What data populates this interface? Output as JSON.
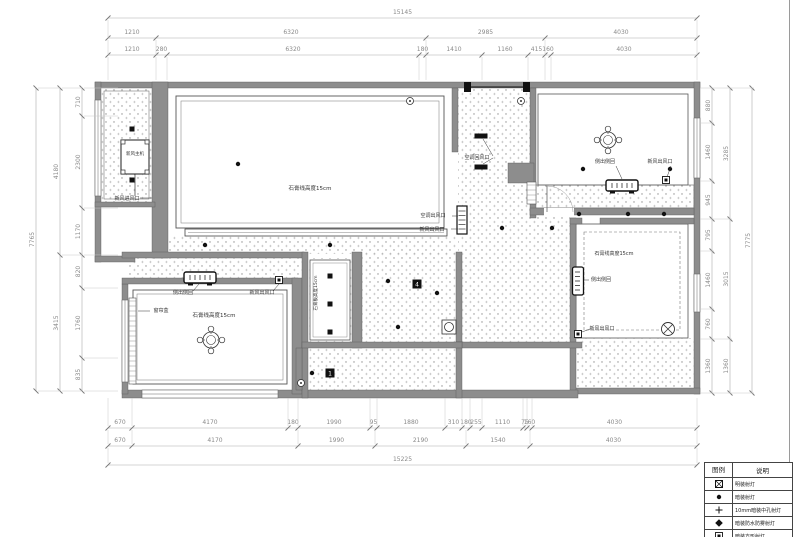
{
  "sheet": {
    "type": "ceiling-lighting-plan",
    "colors": {
      "wall": "#8d8d8d",
      "line": "#555555",
      "dim": "#8a8a8a",
      "black": "#111111",
      "paper": "#ffffff"
    }
  },
  "dimensions": {
    "top_overall": "15145",
    "top_row2": [
      "1210",
      "6320",
      "2985",
      "4030"
    ],
    "top_row3": [
      "1210",
      "280",
      "6320",
      "180",
      "1410",
      "1160",
      "415",
      "160",
      "4030"
    ],
    "bottom_row1": [
      "670",
      "4170",
      "180",
      "1990",
      "95",
      "1880",
      "310",
      "180",
      "255",
      "1110",
      "75",
      "160",
      "4030"
    ],
    "bottom_row2": [
      "670",
      "4170",
      "1990",
      "2190",
      "1540",
      "4030"
    ],
    "bottom_overall": "15225",
    "left_segments": [
      "710",
      "2300",
      "1170",
      "820",
      "1760",
      "835"
    ],
    "left_groups": [
      "4180",
      "3415"
    ],
    "left_overall": "7765",
    "right_segments": [
      "880",
      "1460",
      "945",
      "795",
      "1460",
      "760",
      "1360"
    ],
    "right_groups": [
      "3285",
      "3015",
      "1360"
    ],
    "right_overall": "7775"
  },
  "annotations": [
    {
      "text": "新风主机",
      "x": 135,
      "y": 155,
      "size": 4.5
    },
    {
      "text": "新风进风口",
      "x": 127,
      "y": 200,
      "size": 5
    },
    {
      "text": "石膏线高度15cm",
      "x": 310,
      "y": 190,
      "size": 5.5
    },
    {
      "text": "空调回风口",
      "x": 477,
      "y": 159,
      "size": 5
    },
    {
      "text": "空调出风口",
      "x": 433,
      "y": 217,
      "size": 5
    },
    {
      "text": "新风出风口",
      "x": 432,
      "y": 231,
      "size": 5
    },
    {
      "text": "侧出侧回",
      "x": 605,
      "y": 163,
      "size": 5
    },
    {
      "text": "新风出风口",
      "x": 660,
      "y": 163,
      "size": 5
    },
    {
      "text": "石膏线高度15cm",
      "x": 614,
      "y": 255,
      "size": 5
    },
    {
      "text": "侧出侧回",
      "x": 601,
      "y": 281,
      "size": 5
    },
    {
      "text": "新风出风口",
      "x": 602,
      "y": 330,
      "size": 5
    },
    {
      "text": "侧出侧回",
      "x": 183,
      "y": 294,
      "size": 5
    },
    {
      "text": "新风出风口",
      "x": 262,
      "y": 294,
      "size": 5
    },
    {
      "text": "窗帘盒",
      "x": 161,
      "y": 312,
      "size": 5
    },
    {
      "text": "石膏线高度15cm",
      "x": 214,
      "y": 317,
      "size": 5.5
    },
    {
      "text": "石膏板高度15cm",
      "x": 317,
      "y": 293,
      "size": 4.5,
      "rot": -90
    }
  ],
  "ceiling_tags": [
    {
      "label": "4",
      "x": 417,
      "y": 284
    },
    {
      "label": "1",
      "x": 330,
      "y": 373
    }
  ],
  "legend": {
    "headers": [
      "图例",
      "说明"
    ],
    "rows": [
      {
        "symbol": "boxed-x",
        "label": "明装射灯"
      },
      {
        "symbol": "dot",
        "label": "暗装射灯"
      },
      {
        "symbol": "cross",
        "label": "10mm暗装中孔射灯"
      },
      {
        "symbol": "diamond-dot",
        "label": "暗装防水防雾射灯"
      },
      {
        "symbol": "boxed-square",
        "label": "暗装方形射灯"
      },
      {
        "symbol": "circle",
        "label": ""
      }
    ]
  }
}
